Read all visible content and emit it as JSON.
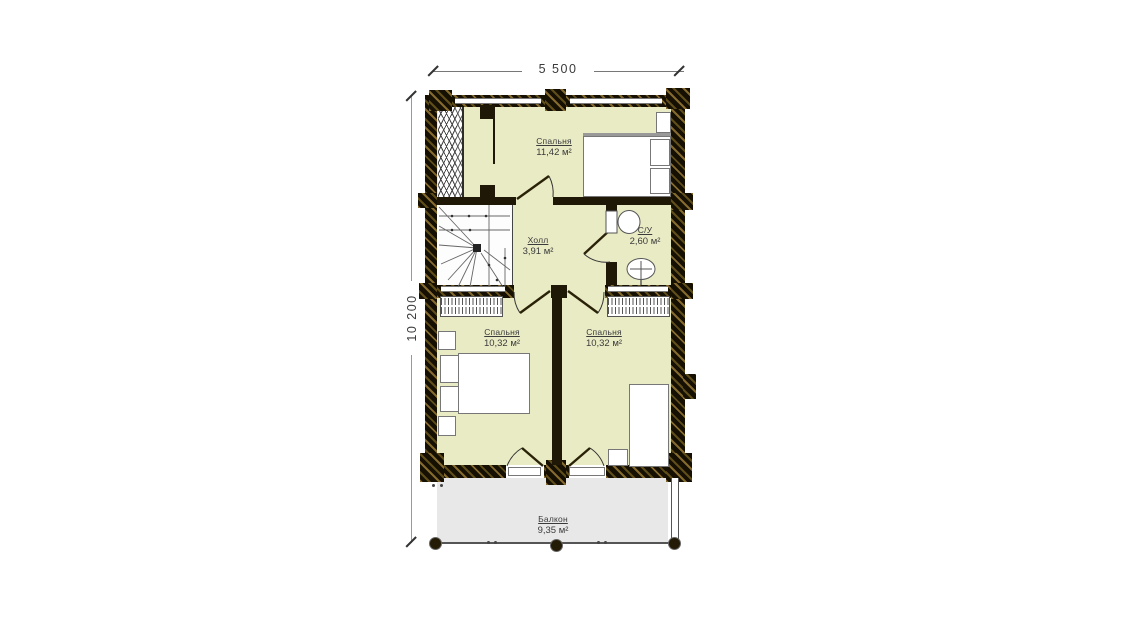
{
  "plan": {
    "title": "second-floor-plan",
    "dimensions": {
      "width": "5 500",
      "height": "10 200"
    },
    "rooms": [
      {
        "name": "Спальня",
        "area": "11,42 м²"
      },
      {
        "name": "Холл",
        "area": "3,91 м²"
      },
      {
        "name": "С/У",
        "area": "2,60 м²"
      },
      {
        "name": "Спальня",
        "area": "10,32 м²"
      },
      {
        "name": "Спальня",
        "area": "10,32 м²"
      },
      {
        "name": "Балкон",
        "area": "9,35 м²"
      }
    ],
    "colors": {
      "floor": "#e9ebc4",
      "balcony_floor": "#e8e8e8",
      "wall_dark": "#241b06",
      "wall_hatch": "#6e5a1e",
      "furniture_outline": "#777777",
      "label_text": "#3b3b3b"
    }
  }
}
